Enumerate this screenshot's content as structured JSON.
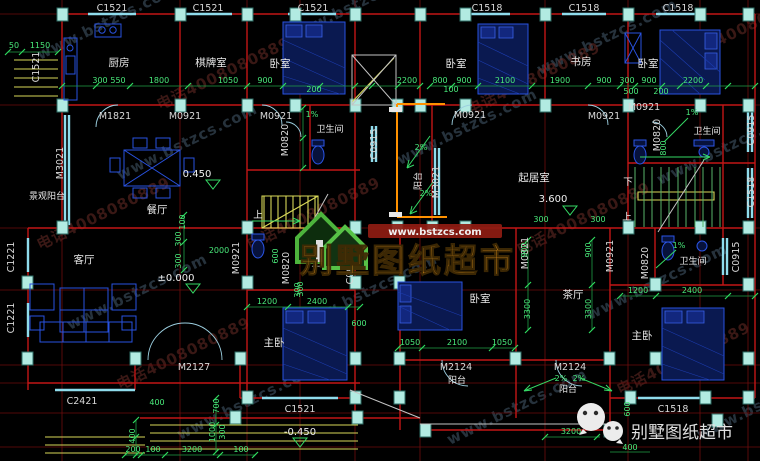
{
  "watermark": {
    "site_url": "www.bstzcs.com",
    "phone": "电话4008080889"
  },
  "logo": {
    "banner_url": "www.bstzcs.com",
    "brand": "别墅图纸超市"
  },
  "footer": {
    "brand": "别墅图纸超市"
  },
  "rooms": {
    "kitchen": "厨房",
    "chess_room": "棋牌室",
    "bedroom_lt": "卧室",
    "bedroom_rt1": "卧室",
    "study": "书房",
    "bedroom_rt2": "卧室",
    "bath_lt": "卫生间",
    "bath_rt": "卫生间",
    "bath_lm": "卫生间",
    "bath_rm": "卫生间",
    "view_balcony": "景观阳台",
    "dining": "餐厅",
    "living": "客厅",
    "sitting": "起居室",
    "master_l": "主卧",
    "bedroom_rb": "卧室",
    "tea_room": "茶厅",
    "master_r": "主卧",
    "balcony_rear": "阳台",
    "balcony_fl": "阳台",
    "balcony_fr": "阳台"
  },
  "windows": {
    "top": [
      "C1521",
      "C1521",
      "C1521",
      "C1518",
      "C1518",
      "C1518"
    ],
    "left": [
      "C1521",
      "C1221",
      "C1221"
    ],
    "mid": [
      "C0915",
      "C0915"
    ],
    "right": [
      "C0915",
      "C1518",
      "C0915"
    ],
    "bottom": [
      "C2421",
      "C1521",
      "C1518"
    ]
  },
  "doors": {
    "row": [
      "M1821",
      "M0921",
      "M0921",
      "M0921",
      "M0921",
      "M0921"
    ],
    "vert": [
      "M0820",
      "M0820",
      "M3021",
      "M3021",
      "M0921",
      "M0820",
      "M0821",
      "M0921",
      "M0820"
    ],
    "bottom": [
      "M2127",
      "M2124",
      "M2124"
    ]
  },
  "elevations": {
    "dining": "0.450",
    "ground": "±0.000",
    "upper": "3.600",
    "entry": "-0.450"
  },
  "slopes": [
    "1%",
    "1%",
    "1%",
    "2%",
    "2%",
    "2%",
    "2%"
  ],
  "stair_marks": [
    "上",
    "下",
    "上"
  ],
  "dims": {
    "top_left": [
      "300",
      "550",
      "1800",
      "1050",
      "900",
      "2200"
    ],
    "top_left_sub": [
      "200"
    ],
    "top_right": [
      "800",
      "900",
      "2100",
      "1900",
      "900",
      "300",
      "900",
      "2200"
    ],
    "top_right_sub": [
      "100",
      "500",
      "200"
    ],
    "left_edge": [
      "50",
      "1150"
    ],
    "mid_left": [
      "100",
      "300",
      "2000",
      "300",
      "600",
      "300"
    ],
    "mid_right": [
      "300",
      "300",
      "900",
      "900",
      "3300",
      "3300",
      "800"
    ],
    "master_l": [
      "1200",
      "2400",
      "300",
      "600"
    ],
    "bed_rb": [
      "1050",
      "2100",
      "1050"
    ],
    "master_r": [
      "1200",
      "2400"
    ],
    "bottom_left": [
      "400",
      "400",
      "700",
      "1000",
      "300",
      "200",
      "100",
      "3200",
      "100"
    ],
    "bottom_right": [
      "3200",
      "400",
      "600"
    ]
  },
  "colors": {
    "background": "#000000",
    "wall_red": "#c21616",
    "grid_red": "#6e0d0d",
    "window_cyan": "#8fdcec",
    "column_teal": "#b2ebe2",
    "dim_green": "#49e97a",
    "furniture_blue": "#2952e0",
    "stair_yellow": "#d8d858",
    "section_orange": "#ff9100",
    "logo_green": "#4db43c",
    "logo_orange": "#c9841c",
    "banner_red": "#8f1c12"
  }
}
